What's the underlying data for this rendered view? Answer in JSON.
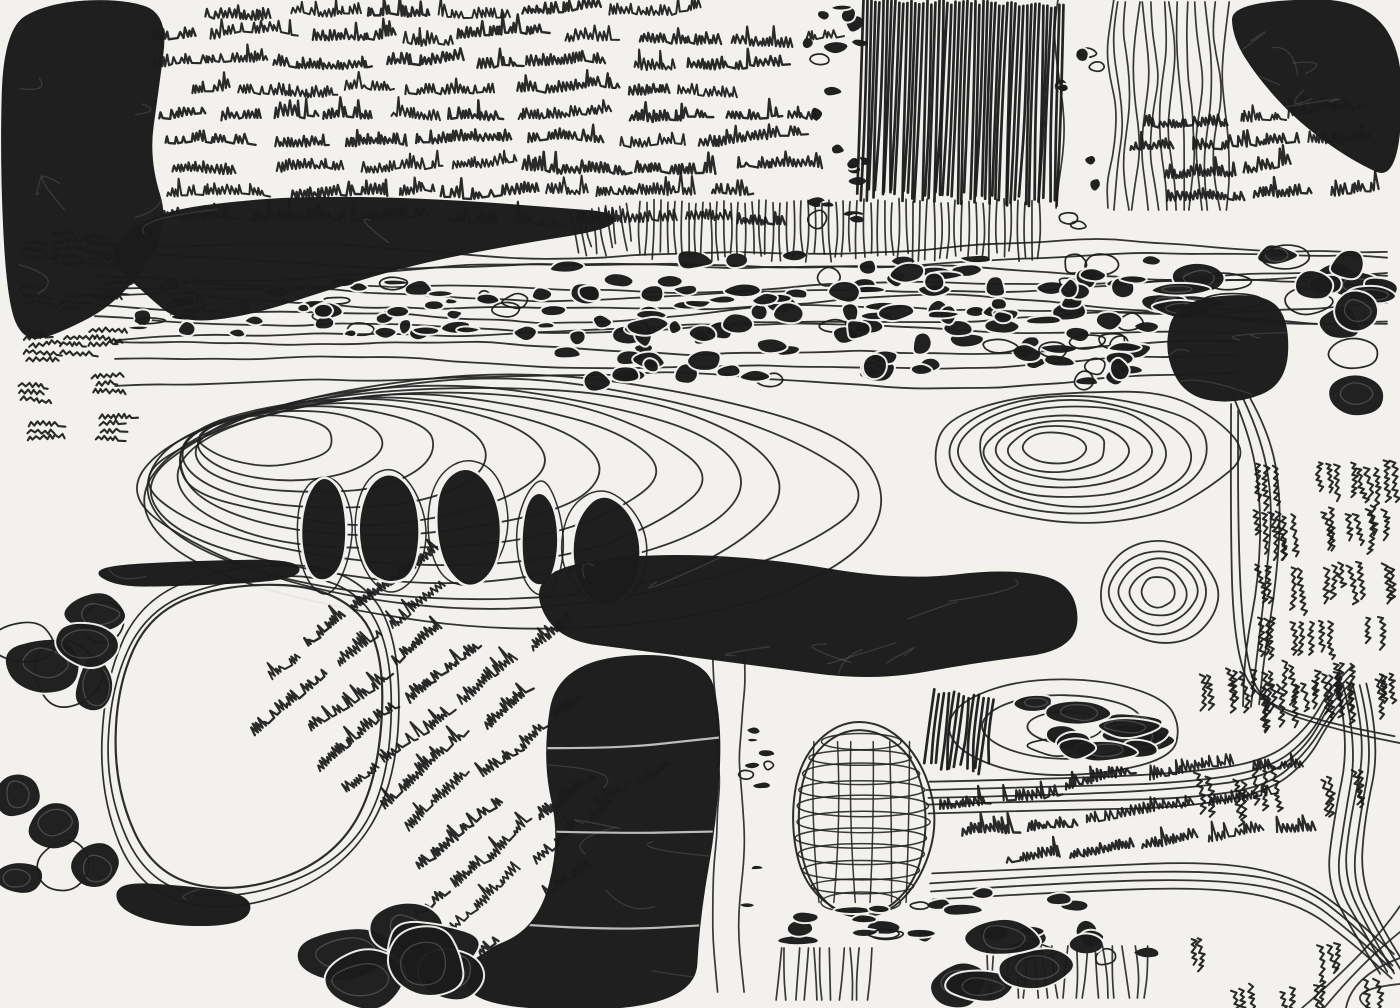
{
  "artwork": {
    "title": "Untitled abstract ink drawing (asemic map)",
    "canvas": {
      "width": 1400,
      "height": 1008
    },
    "palette": {
      "paper": "#f2f1ee",
      "ink": "#1b1b1b",
      "line": "#232323"
    },
    "seed": 11,
    "regions": [
      {
        "type": "contours",
        "name": "upper-contour-band",
        "x": 95,
        "y": 250,
        "w": 1305,
        "h": 74,
        "lines": 8,
        "amp": 7
      },
      {
        "type": "contours",
        "name": "upper-contour-band-2",
        "x": 115,
        "y": 332,
        "w": 1150,
        "h": 46,
        "lines": 4,
        "amp": 6
      },
      {
        "type": "basin",
        "name": "central-basin-west",
        "cx": 520,
        "cy": 500,
        "rx": 392,
        "ry": 128,
        "loops": 12,
        "driftX": -275,
        "driftY": -66
      },
      {
        "type": "basin",
        "name": "central-basin-east",
        "cx": 1085,
        "cy": 455,
        "rx": 152,
        "ry": 68,
        "loops": 8,
        "driftX": -35,
        "driftY": -8
      },
      {
        "type": "basin",
        "name": "contour-rose",
        "cx": 1158,
        "cy": 592,
        "rx": 62,
        "ry": 52,
        "loops": 5,
        "driftX": 0,
        "driftY": 0
      },
      {
        "type": "channel",
        "name": "east-channel",
        "pts": [
          [
            1238,
            388
          ],
          [
            1260,
            430
          ],
          [
            1272,
            500
          ],
          [
            1266,
            580
          ],
          [
            1256,
            650
          ],
          [
            1252,
            706
          ]
        ],
        "n": 3,
        "gap": 9,
        "axis": "x"
      },
      {
        "type": "channel",
        "name": "tally-field-border",
        "pts": [
          [
            1236,
            408
          ],
          [
            1233,
            520
          ],
          [
            1238,
            642
          ],
          [
            1256,
            702
          ],
          [
            1336,
            726
          ],
          [
            1400,
            738
          ]
        ],
        "n": 2,
        "gap": 10,
        "axis": "b"
      },
      {
        "type": "channel",
        "name": "se-channel-upper",
        "pts": [
          [
            928,
            798
          ],
          [
            1060,
            794
          ],
          [
            1180,
            790
          ],
          [
            1266,
            778
          ],
          [
            1308,
            744
          ],
          [
            1330,
            704
          ],
          [
            1350,
            684
          ]
        ],
        "n": 5,
        "gap": 8,
        "axis": "y"
      },
      {
        "type": "channel",
        "name": "se-channel-hook",
        "pts": [
          [
            1352,
            684
          ],
          [
            1366,
            742
          ],
          [
            1350,
            822
          ],
          [
            1344,
            882
          ],
          [
            1370,
            932
          ],
          [
            1396,
            974
          ]
        ],
        "n": 5,
        "gap": 8,
        "axis": "x"
      },
      {
        "type": "channel",
        "name": "se-channel-lower",
        "pts": [
          [
            932,
            886
          ],
          [
            1080,
            878
          ],
          [
            1220,
            874
          ],
          [
            1300,
            890
          ],
          [
            1352,
            930
          ],
          [
            1392,
            968
          ]
        ],
        "n": 4,
        "gap": 8,
        "axis": "y"
      },
      {
        "type": "corner",
        "name": "se-corner-contours"
      },
      {
        "type": "lake",
        "name": "white-lake",
        "loops": 3,
        "points": [
          [
            118,
            688
          ],
          [
            152,
            612
          ],
          [
            232,
            584
          ],
          [
            330,
            584
          ],
          [
            386,
            636
          ],
          [
            382,
            778
          ],
          [
            334,
            858
          ],
          [
            236,
            894
          ],
          [
            152,
            876
          ],
          [
            112,
            788
          ]
        ]
      },
      {
        "type": "blob",
        "name": "west-dark-streak",
        "scratches": 2,
        "points": [
          [
            90,
            566
          ],
          [
            200,
            560
          ],
          [
            300,
            562
          ],
          [
            298,
            580
          ],
          [
            180,
            584
          ],
          [
            118,
            584
          ]
        ]
      },
      {
        "type": "lens",
        "name": "pebble-lens-outline",
        "cx": 1065,
        "cy": 727,
        "rx": 124,
        "ry": 48,
        "loops": 3
      },
      {
        "type": "mesh",
        "name": "basket-grid",
        "cx": 862,
        "cy": 822,
        "rx": 68,
        "ry": 98,
        "coils": 11,
        "vlines": 6
      },
      {
        "type": "pebbles",
        "name": "pebble-band-west",
        "x": 118,
        "y": 280,
        "w": 440,
        "h": 56,
        "count": 55,
        "rmin": 4,
        "rmax": 11,
        "elong": 1.5
      },
      {
        "type": "pebbles",
        "name": "pebble-band-central",
        "x": 560,
        "y": 253,
        "w": 600,
        "h": 132,
        "count": 130,
        "rmin": 6,
        "rmax": 15,
        "elong": 1.35
      },
      {
        "type": "pebbles",
        "name": "pebble-band-east",
        "x": 1152,
        "y": 246,
        "w": 248,
        "h": 74,
        "count": 16,
        "rmin": 9,
        "rmax": 20,
        "elong": 1.8
      },
      {
        "type": "pebbles",
        "name": "top-pebble-column",
        "x": 805,
        "y": 2,
        "w": 62,
        "h": 228,
        "count": 20,
        "rmin": 5,
        "rmax": 11,
        "elong": 1.25
      },
      {
        "type": "pebbles",
        "name": "top-channel-edge-pebbles",
        "x": 1050,
        "y": 24,
        "w": 64,
        "h": 204,
        "count": 9,
        "rmin": 5,
        "rmax": 10,
        "elong": 1.1,
        "outline": 0.7
      },
      {
        "type": "pebbles",
        "name": "left-pebble-column",
        "x": 4,
        "y": 452,
        "w": 110,
        "h": 452,
        "count": 12,
        "rmin": 20,
        "rmax": 42,
        "elong": 1.05
      },
      {
        "type": "pebbles",
        "name": "lens-pebbles",
        "x": 962,
        "y": 698,
        "w": 206,
        "h": 58,
        "count": 12,
        "rmin": 9,
        "rmax": 18,
        "elong": 2
      },
      {
        "type": "pebbles",
        "name": "channel-bits",
        "x": 744,
        "y": 702,
        "w": 26,
        "h": 300,
        "count": 9,
        "rmin": 4,
        "rmax": 8,
        "elong": 1.2
      },
      {
        "type": "pebbles",
        "name": "below-basket-pebbles",
        "x": 784,
        "y": 902,
        "w": 176,
        "h": 52,
        "count": 15,
        "rmin": 5,
        "rmax": 12,
        "elong": 1.7
      },
      {
        "type": "pebbles",
        "name": "se-mid-pebbles",
        "x": 930,
        "y": 884,
        "w": 222,
        "h": 76,
        "count": 14,
        "rmin": 7,
        "rmax": 15,
        "elong": 1.5
      },
      {
        "type": "vlines",
        "name": "top-vlines-band",
        "x": 1118,
        "y": 2,
        "w": 112,
        "h": 230,
        "gap": 9,
        "amp": 4
      },
      {
        "type": "vlines",
        "name": "top-channel-borders",
        "x": 1060,
        "y": 0,
        "w": 56,
        "h": 232,
        "gap": 52,
        "amp": 5
      },
      {
        "type": "vlines",
        "name": "bottom-channel-borders",
        "x": 716,
        "y": 654,
        "w": 30,
        "h": 354,
        "gap": 26,
        "amp": 3
      },
      {
        "type": "vlines",
        "name": "bottom-vlines-west",
        "x": 778,
        "y": 948,
        "w": 96,
        "h": 60,
        "gap": 9,
        "amp": 3
      },
      {
        "type": "vlines",
        "name": "bottom-vlines-east",
        "x": 985,
        "y": 946,
        "w": 160,
        "h": 62,
        "gap": 10,
        "amp": 4
      },
      {
        "type": "hatch",
        "name": "top-dark-band",
        "x": 860,
        "y": 0,
        "w": 202,
        "h": 204,
        "gap": 4,
        "rot": 2,
        "light": false
      },
      {
        "type": "hatch",
        "name": "mid-vertical-hatch",
        "x": 640,
        "y": 198,
        "w": 400,
        "h": 64,
        "gap": 7,
        "rot": 0,
        "light": true
      },
      {
        "type": "hatch",
        "name": "mid-vertical-hatch-west",
        "x": 574,
        "y": 206,
        "w": 62,
        "h": 50,
        "gap": 7,
        "rot": -8,
        "light": true
      },
      {
        "type": "hatch",
        "name": "lens-west-hatch",
        "x": 930,
        "y": 692,
        "w": 60,
        "h": 80,
        "gap": 5,
        "rot": 6,
        "light": false
      },
      {
        "type": "tally",
        "name": "left-tally-column",
        "x": 6,
        "y": 236,
        "w": 108,
        "h": 220,
        "cols": 3,
        "rows": 5,
        "mode": "h"
      },
      {
        "type": "tally",
        "name": "east-tally-field",
        "x": 1250,
        "y": 436,
        "w": 148,
        "h": 262,
        "cols": 5,
        "rows": 5,
        "mode": "v"
      },
      {
        "type": "tally",
        "name": "se-cluster-row-1",
        "x": 1192,
        "y": 654,
        "w": 205,
        "h": 54,
        "cols": 6,
        "rows": 1,
        "mode": "v"
      },
      {
        "type": "tally",
        "name": "se-cluster-row-2",
        "x": 1188,
        "y": 746,
        "w": 195,
        "h": 56,
        "cols": 6,
        "rows": 1,
        "mode": "v"
      },
      {
        "type": "tally",
        "name": "se-cluster-field",
        "x": 1168,
        "y": 920,
        "w": 230,
        "h": 86,
        "cols": 5,
        "rows": 2,
        "mode": "v"
      },
      {
        "type": "asemic",
        "name": "top-text-block",
        "x": 152,
        "y": 2,
        "w": 702,
        "h": 232,
        "rows": 9,
        "rot": 0
      },
      {
        "type": "asemic",
        "name": "top-right-text-block",
        "x": 1124,
        "y": 106,
        "w": 276,
        "h": 106,
        "rows": 4,
        "rot": -2
      },
      {
        "type": "asemic",
        "name": "lake-east-diagonal-text",
        "x": 286,
        "y": 566,
        "w": 330,
        "h": 380,
        "rows": 11,
        "rot": -38,
        "stagger": true
      },
      {
        "type": "asemic",
        "name": "se-text-band",
        "x": 936,
        "y": 766,
        "w": 420,
        "h": 98,
        "rows": 3,
        "rot": -7
      },
      {
        "type": "blob",
        "name": "top-left-mass",
        "scratches": 8,
        "points": [
          [
            4,
            28
          ],
          [
            46,
            4
          ],
          [
            118,
            0
          ],
          [
            168,
            16
          ],
          [
            158,
            92
          ],
          [
            148,
            160
          ],
          [
            170,
            232
          ],
          [
            120,
            300
          ],
          [
            58,
            330
          ],
          [
            26,
            342
          ],
          [
            6,
            300
          ],
          [
            0,
            160
          ]
        ]
      },
      {
        "type": "blob",
        "name": "ink-slug",
        "scratches": 6,
        "points": [
          [
            104,
            252
          ],
          [
            150,
            214
          ],
          [
            260,
            198
          ],
          [
            360,
            197
          ],
          [
            470,
            203
          ],
          [
            560,
            208
          ],
          [
            616,
            214
          ],
          [
            612,
            228
          ],
          [
            520,
            244
          ],
          [
            420,
            262
          ],
          [
            330,
            290
          ],
          [
            250,
            316
          ],
          [
            180,
            322
          ],
          [
            146,
            292
          ]
        ]
      },
      {
        "type": "blob",
        "name": "top-right-mass",
        "scratches": 7,
        "points": [
          [
            1232,
            0
          ],
          [
            1400,
            0
          ],
          [
            1400,
            182
          ],
          [
            1352,
            158
          ],
          [
            1300,
            122
          ],
          [
            1258,
            78
          ],
          [
            1232,
            36
          ]
        ]
      },
      {
        "type": "blob",
        "name": "east-dark-block",
        "scratches": 5,
        "points": [
          [
            1176,
            302
          ],
          [
            1262,
            292
          ],
          [
            1290,
            320
          ],
          [
            1286,
            382
          ],
          [
            1238,
            402
          ],
          [
            1186,
            394
          ],
          [
            1164,
            352
          ]
        ]
      },
      {
        "type": "pebbles",
        "name": "east-dark-tall-shapes",
        "x": 1300,
        "y": 264,
        "w": 100,
        "h": 138,
        "count": 5,
        "rmin": 17,
        "rmax": 28,
        "elong": 1.15
      },
      {
        "type": "slabs",
        "name": "mid-dark-slabs",
        "items": [
          [
            325,
            532,
            25,
            55,
            -6
          ],
          [
            390,
            529,
            32,
            57,
            3
          ],
          [
            467,
            527,
            36,
            60,
            -3
          ],
          [
            540,
            540,
            20,
            52,
            6
          ],
          [
            606,
            550,
            38,
            56,
            -7
          ]
        ]
      },
      {
        "type": "blob",
        "name": "central-dark-band",
        "scratches": 9,
        "points": [
          [
            530,
            576
          ],
          [
            624,
            554
          ],
          [
            760,
            558
          ],
          [
            900,
            584
          ],
          [
            1012,
            568
          ],
          [
            1076,
            584
          ],
          [
            1076,
            648
          ],
          [
            980,
            660
          ],
          [
            872,
            680
          ],
          [
            760,
            664
          ],
          [
            640,
            650
          ],
          [
            556,
            640
          ]
        ]
      },
      {
        "type": "blob",
        "name": "bottom-dark-mass",
        "scratches": 10,
        "seams": true,
        "points": [
          [
            558,
            660
          ],
          [
            706,
            654
          ],
          [
            722,
            724
          ],
          [
            716,
            820
          ],
          [
            700,
            920
          ],
          [
            692,
            1008
          ],
          [
            470,
            1008
          ],
          [
            472,
            958
          ],
          [
            540,
            928
          ],
          [
            560,
            840
          ],
          [
            544,
            758
          ]
        ]
      },
      {
        "type": "blob",
        "name": "lake-south-rim",
        "scratches": 2,
        "points": [
          [
            118,
            884
          ],
          [
            180,
            886
          ],
          [
            252,
            896
          ],
          [
            246,
            924
          ],
          [
            168,
            924
          ],
          [
            120,
            908
          ]
        ]
      },
      {
        "type": "pebbles",
        "name": "bottom-center-lumps",
        "x": 236,
        "y": 904,
        "w": 240,
        "h": 102,
        "count": 6,
        "rmin": 26,
        "rmax": 50,
        "elong": 1.15
      },
      {
        "type": "pebbles",
        "name": "se-dark-rounds",
        "x": 936,
        "y": 926,
        "w": 140,
        "h": 80,
        "count": 4,
        "rmin": 24,
        "rmax": 40,
        "elong": 1.1
      }
    ]
  }
}
